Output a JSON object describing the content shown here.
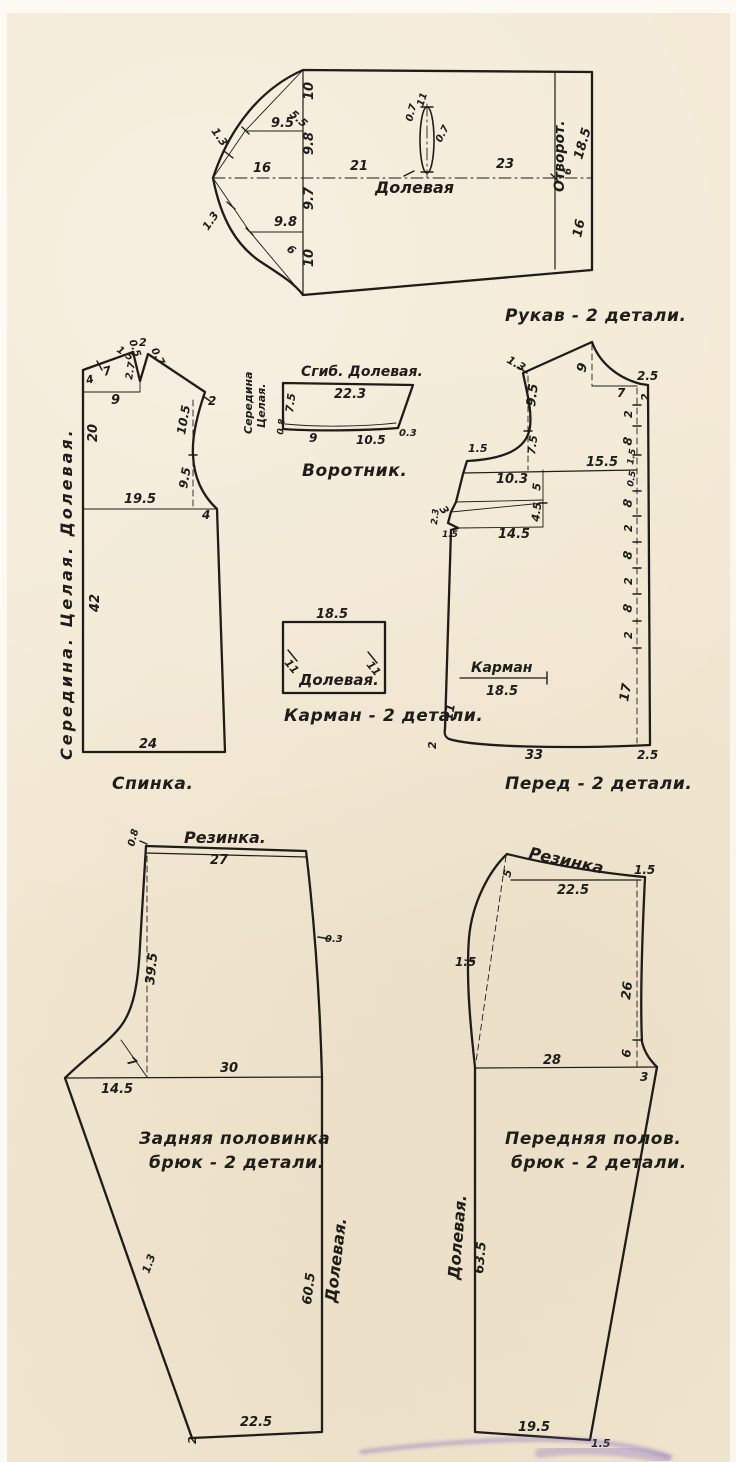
{
  "page": {
    "background": "#f3e9d4",
    "ink": "#1f1d1a",
    "margin_color": "#fcfaf2",
    "smudge_color": "#7a5fc0"
  },
  "pieces": {
    "sleeve": {
      "labels": [
        {
          "t": "10",
          "x": 313,
          "y": 100,
          "r": -90
        },
        {
          "t": "5.5",
          "x": 289,
          "y": 115,
          "r": 42,
          "fs": 11
        },
        {
          "t": "9.5",
          "x": 271,
          "y": 127
        },
        {
          "t": "1.3",
          "x": 211,
          "y": 131,
          "r": 55,
          "fs": 11
        },
        {
          "t": "16",
          "x": 253,
          "y": 172
        },
        {
          "t": "9.8",
          "x": 313,
          "y": 155,
          "r": -90
        },
        {
          "t": "21",
          "x": 350,
          "y": 170
        },
        {
          "t": "Долевая",
          "x": 375,
          "y": 193,
          "fs": 16,
          "n": "grain-line-label"
        },
        {
          "t": "11",
          "x": 423,
          "y": 107,
          "r": -72,
          "fs": 10
        },
        {
          "t": "0.7",
          "x": 412,
          "y": 122,
          "r": -75,
          "fs": 10
        },
        {
          "t": "0.7",
          "x": 441,
          "y": 143,
          "r": -62,
          "fs": 10
        },
        {
          "t": "23",
          "x": 496,
          "y": 168
        },
        {
          "t": "Отворот.",
          "x": 564,
          "y": 192,
          "r": -90,
          "fs": 14,
          "n": "cuff-label"
        },
        {
          "t": "18.5",
          "x": 582,
          "y": 160,
          "r": -74
        },
        {
          "t": "6",
          "x": 571,
          "y": 175,
          "r": -90,
          "fs": 10
        },
        {
          "t": "16",
          "x": 581,
          "y": 238,
          "r": -78
        },
        {
          "t": "9.7",
          "x": 313,
          "y": 210,
          "r": -90
        },
        {
          "t": "9.8",
          "x": 274,
          "y": 226
        },
        {
          "t": "6",
          "x": 286,
          "y": 250,
          "r": 40,
          "fs": 11
        },
        {
          "t": "1.3",
          "x": 208,
          "y": 231,
          "r": -55,
          "fs": 11
        },
        {
          "t": "10",
          "x": 313,
          "y": 267,
          "r": -90
        },
        {
          "t": "Рукав - 2 детали.",
          "x": 505,
          "y": 321,
          "fs": 17,
          "cls": "pname",
          "n": "piece-name-label"
        }
      ]
    },
    "back": {
      "labels": [
        {
          "t": "1.5",
          "x": 116,
          "y": 351,
          "r": 35,
          "fs": 10
        },
        {
          "t": "0.5",
          "x": 129,
          "y": 341,
          "r": 70,
          "fs": 10
        },
        {
          "t": "2",
          "x": 139,
          "y": 346,
          "fs": 11
        },
        {
          "t": "0.7",
          "x": 151,
          "y": 350,
          "r": 62,
          "fs": 10
        },
        {
          "t": "4",
          "x": 87,
          "y": 384,
          "r": -14,
          "fs": 11
        },
        {
          "t": "7",
          "x": 104,
          "y": 376,
          "r": -14,
          "fs": 12
        },
        {
          "t": "2.7",
          "x": 132,
          "y": 380,
          "r": -80,
          "fs": 10
        },
        {
          "t": "9",
          "x": 111,
          "y": 404
        },
        {
          "t": "2",
          "x": 208,
          "y": 405,
          "fs": 12
        },
        {
          "t": "10.5",
          "x": 185,
          "y": 435,
          "r": -80,
          "fs": 12
        },
        {
          "t": "9.5",
          "x": 187,
          "y": 489,
          "r": -80,
          "fs": 12
        },
        {
          "t": "20",
          "x": 97,
          "y": 442,
          "r": -90
        },
        {
          "t": "19.5",
          "x": 124,
          "y": 503
        },
        {
          "t": "4",
          "x": 202,
          "y": 519,
          "fs": 12
        },
        {
          "t": "42",
          "x": 99,
          "y": 612,
          "r": -90
        },
        {
          "t": "24",
          "x": 139,
          "y": 748
        },
        {
          "t": "Середина.  Целая.  Долевая.",
          "x": 72,
          "y": 760,
          "r": -90,
          "fs": 16,
          "cls": "spread",
          "n": "center-grain-label"
        },
        {
          "t": "Спинка.",
          "x": 112,
          "y": 789,
          "fs": 17,
          "cls": "pname",
          "n": "piece-name-label"
        }
      ]
    },
    "collar": {
      "labels": [
        {
          "t": "Сгиб.  Долевая.",
          "x": 301,
          "y": 376,
          "fs": 14,
          "n": "fold-grain-label"
        },
        {
          "t": "22.3",
          "x": 334,
          "y": 398
        },
        {
          "t": "Середина",
          "x": 252,
          "y": 434,
          "r": -90,
          "fs": 11,
          "n": "center-label"
        },
        {
          "t": "Целая.",
          "x": 265,
          "y": 428,
          "r": -90,
          "fs": 11,
          "n": "center-label"
        },
        {
          "t": "7.5",
          "x": 293,
          "y": 413,
          "r": -83,
          "fs": 11
        },
        {
          "t": "0.8",
          "x": 283,
          "y": 435,
          "r": -83,
          "fs": 9
        },
        {
          "t": "9",
          "x": 309,
          "y": 442,
          "fs": 12
        },
        {
          "t": "10.5",
          "x": 356,
          "y": 444,
          "fs": 12
        },
        {
          "t": "0.3",
          "x": 399,
          "y": 436,
          "fs": 10
        },
        {
          "t": "Воротник.",
          "x": 302,
          "y": 476,
          "fs": 17,
          "cls": "pname",
          "n": "piece-name-label"
        }
      ]
    },
    "front": {
      "labels": [
        {
          "t": "1.3",
          "x": 506,
          "y": 362,
          "r": 30,
          "fs": 11
        },
        {
          "t": "9",
          "x": 585,
          "y": 373,
          "r": -75
        },
        {
          "t": "2.5",
          "x": 637,
          "y": 380,
          "fs": 12
        },
        {
          "t": "7",
          "x": 617,
          "y": 397,
          "fs": 12
        },
        {
          "t": "2",
          "x": 649,
          "y": 401,
          "r": -90,
          "fs": 11
        },
        {
          "t": "9.5",
          "x": 535,
          "y": 407,
          "r": -83
        },
        {
          "t": "7.5",
          "x": 535,
          "y": 455,
          "r": -83,
          "fs": 11
        },
        {
          "t": "1.5",
          "x": 468,
          "y": 452,
          "fs": 11
        },
        {
          "t": "15.5",
          "x": 586,
          "y": 466
        },
        {
          "t": "10.3",
          "x": 496,
          "y": 483
        },
        {
          "t": "5",
          "x": 540,
          "y": 491,
          "r": -83,
          "fs": 11
        },
        {
          "t": "3",
          "x": 439,
          "y": 509,
          "r": 55,
          "fs": 11
        },
        {
          "t": "2.3",
          "x": 437,
          "y": 525,
          "r": -83,
          "fs": 9
        },
        {
          "t": "1.5",
          "x": 442,
          "y": 537,
          "fs": 9
        },
        {
          "t": "4.5",
          "x": 539,
          "y": 522,
          "r": -83,
          "fs": 11
        },
        {
          "t": "14.5",
          "x": 498,
          "y": 538
        },
        {
          "t": "2",
          "x": 632,
          "y": 418,
          "r": -90,
          "fs": 11
        },
        {
          "t": "8",
          "x": 631,
          "y": 446,
          "r": -80,
          "fs": 12
        },
        {
          "t": "1.5",
          "x": 633,
          "y": 465,
          "r": -80,
          "fs": 9
        },
        {
          "t": "0.5",
          "x": 633,
          "y": 487,
          "r": -80,
          "fs": 9
        },
        {
          "t": "8",
          "x": 631,
          "y": 508,
          "r": -80,
          "fs": 12
        },
        {
          "t": "2",
          "x": 632,
          "y": 532,
          "r": -90,
          "fs": 11
        },
        {
          "t": "8",
          "x": 631,
          "y": 560,
          "r": -80,
          "fs": 12
        },
        {
          "t": "2",
          "x": 632,
          "y": 585,
          "r": -90,
          "fs": 11
        },
        {
          "t": "8",
          "x": 631,
          "y": 613,
          "r": -80,
          "fs": 12
        },
        {
          "t": "2",
          "x": 632,
          "y": 639,
          "r": -90,
          "fs": 11
        },
        {
          "t": "17",
          "x": 628,
          "y": 702,
          "r": -80
        },
        {
          "t": "Карман",
          "x": 471,
          "y": 672,
          "fs": 14,
          "n": "pocket-line-label"
        },
        {
          "t": "18.5",
          "x": 486,
          "y": 695
        },
        {
          "t": "11",
          "x": 452,
          "y": 721,
          "r": -80,
          "fs": 12
        },
        {
          "t": "2",
          "x": 436,
          "y": 749,
          "r": -90,
          "fs": 11
        },
        {
          "t": "33",
          "x": 525,
          "y": 759
        },
        {
          "t": "2.5",
          "x": 637,
          "y": 759,
          "fs": 12
        },
        {
          "t": "Перед - 2 детали.",
          "x": 505,
          "y": 789,
          "fs": 17,
          "cls": "pname",
          "n": "piece-name-label"
        }
      ]
    },
    "pocket": {
      "labels": [
        {
          "t": "18.5",
          "x": 316,
          "y": 618
        },
        {
          "t": "11",
          "x": 284,
          "y": 663,
          "r": 50,
          "fs": 11
        },
        {
          "t": "11",
          "x": 366,
          "y": 665,
          "r": 50,
          "fs": 11
        },
        {
          "t": "Долевая.",
          "x": 299,
          "y": 685,
          "fs": 15,
          "n": "grain-line-label"
        },
        {
          "t": "Карман - 2 детали.",
          "x": 284,
          "y": 721,
          "fs": 17,
          "cls": "pname",
          "n": "piece-name-label"
        }
      ]
    },
    "trouser_back": {
      "labels": [
        {
          "t": "Резинка.",
          "x": 184,
          "y": 843,
          "fs": 16,
          "n": "elastic-label"
        },
        {
          "t": "0.8",
          "x": 134,
          "y": 847,
          "r": -75,
          "fs": 10
        },
        {
          "t": "27",
          "x": 210,
          "y": 864
        },
        {
          "t": "0.3",
          "x": 325,
          "y": 942,
          "fs": 10
        },
        {
          "t": "39.5",
          "x": 154,
          "y": 985,
          "r": -84
        },
        {
          "t": "7",
          "x": 126,
          "y": 1062,
          "r": 42,
          "fs": 12
        },
        {
          "t": "14.5",
          "x": 101,
          "y": 1093
        },
        {
          "t": "30",
          "x": 220,
          "y": 1072
        },
        {
          "t": "Задняя половинка",
          "x": 139,
          "y": 1144,
          "fs": 17,
          "cls": "pname",
          "n": "piece-name-label"
        },
        {
          "t": "брюк - 2 детали.",
          "x": 149,
          "y": 1168,
          "fs": 17,
          "cls": "pname",
          "n": "piece-name-label"
        },
        {
          "t": "1.3",
          "x": 149,
          "y": 1274,
          "r": -70,
          "fs": 11
        },
        {
          "t": "60.5",
          "x": 311,
          "y": 1305,
          "r": -83
        },
        {
          "t": "Долевая.",
          "x": 336,
          "y": 1303,
          "r": -83,
          "fs": 16,
          "n": "grain-line-label"
        },
        {
          "t": "2",
          "x": 196,
          "y": 1444,
          "r": -90,
          "fs": 11
        },
        {
          "t": "22.5",
          "x": 240,
          "y": 1426
        }
      ]
    },
    "trouser_front": {
      "labels": [
        {
          "t": "Резинка",
          "x": 528,
          "y": 858,
          "r": 12,
          "fs": 16,
          "n": "elastic-label"
        },
        {
          "t": "5",
          "x": 510,
          "y": 878,
          "r": -75,
          "fs": 11
        },
        {
          "t": "22.5",
          "x": 557,
          "y": 894
        },
        {
          "t": "1.5",
          "x": 634,
          "y": 874,
          "fs": 12
        },
        {
          "t": "1.5",
          "x": 455,
          "y": 966,
          "fs": 12
        },
        {
          "t": "26",
          "x": 630,
          "y": 1000,
          "r": -83
        },
        {
          "t": "6",
          "x": 630,
          "y": 1058,
          "r": -83,
          "fs": 12
        },
        {
          "t": "28",
          "x": 543,
          "y": 1064
        },
        {
          "t": "3",
          "x": 640,
          "y": 1081,
          "fs": 12
        },
        {
          "t": "Передняя полов.",
          "x": 505,
          "y": 1144,
          "fs": 17,
          "cls": "pname",
          "n": "piece-name-label"
        },
        {
          "t": "брюк - 2 детали.",
          "x": 511,
          "y": 1168,
          "fs": 17,
          "cls": "pname",
          "n": "piece-name-label"
        },
        {
          "t": "Долевая.",
          "x": 459,
          "y": 1280,
          "r": -85,
          "fs": 16,
          "n": "grain-line-label"
        },
        {
          "t": "63.5",
          "x": 483,
          "y": 1274,
          "r": -85
        },
        {
          "t": "19.5",
          "x": 518,
          "y": 1431
        },
        {
          "t": "1.5",
          "x": 591,
          "y": 1447,
          "fs": 11
        }
      ]
    }
  }
}
